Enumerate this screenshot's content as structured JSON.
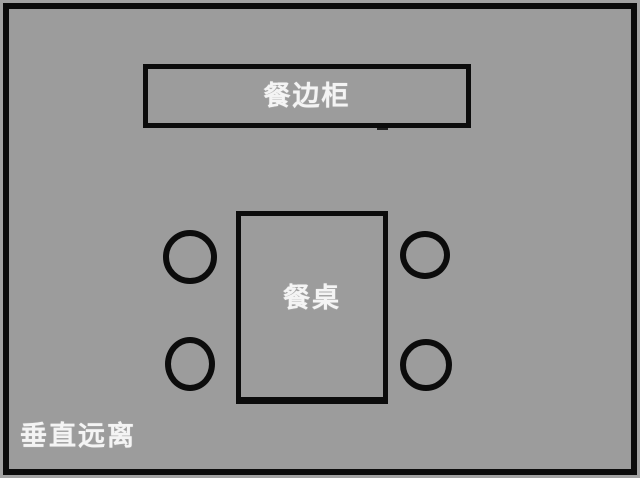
{
  "diagram": {
    "type": "floor-plan",
    "furniture": {
      "sideboard": {
        "label": "餐边柜"
      },
      "dining_table": {
        "label": "餐桌"
      },
      "chairs": {
        "count": 4,
        "shape": "circle",
        "arrangement": "two on each long side of the table"
      }
    },
    "caption": "垂直远离",
    "colors": {
      "room_fill": "#9c9c9c",
      "outer_margin": "#a3a3a3",
      "outline": "#0c0c0c",
      "label_text": "#f4f4f4"
    }
  }
}
